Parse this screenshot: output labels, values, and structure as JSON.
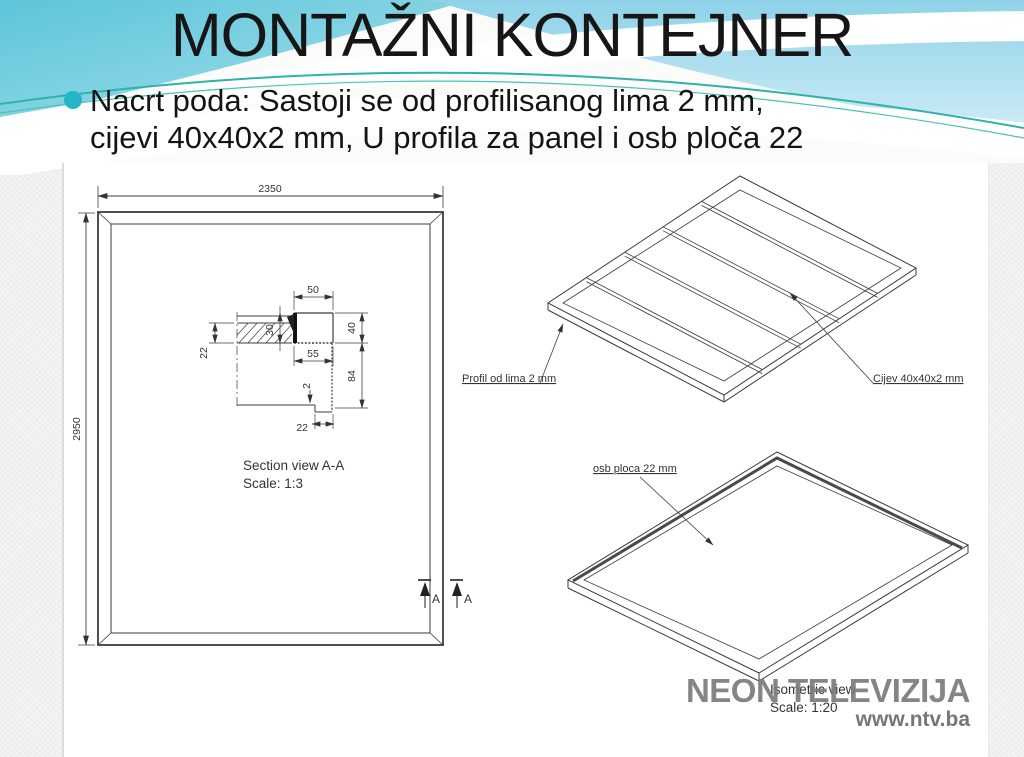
{
  "slide": {
    "title": "MONTAŽNI KONTEJNER",
    "bullet": {
      "line1": "Nacrt poda: Sastoji se od profilisanog lima 2 mm,",
      "line2": "cijevi 40x40x2 mm, U profila za panel i osb ploča 22"
    }
  },
  "colors": {
    "accent_teal": "#25b5c6",
    "wave_cyan": "#63c7da",
    "wave_blue": "#9bd8ec",
    "wave_line": "#2fb3a8",
    "line_color": "#3c3c3c",
    "watermark_gray": "#7b7b7b"
  },
  "plan": {
    "width_dim": "2350",
    "height_dim": "2950",
    "section_marker_1": "A",
    "section_marker_2": "A"
  },
  "section": {
    "caption_line1": "Section view A-A",
    "caption_line2": "Scale: 1:3",
    "dim_top": "50",
    "dim_tube_height": "40",
    "dim_mid": "55",
    "dim_lower_height": "84",
    "dim_left": "22",
    "dim_osb": "30",
    "dim_sheet": "2",
    "dim_bottom": "22"
  },
  "frame_iso": {
    "label_left": "Profil od lima 2 mm",
    "label_right": "Cijev 40x40x2 mm"
  },
  "panel_iso": {
    "label": "osb ploca 22 mm",
    "caption_line1": "Isometric view",
    "caption_line2": "Scale: 1:20"
  },
  "watermark": {
    "name": "NEON TELEVIZIJA",
    "url": "www.ntv.ba"
  }
}
